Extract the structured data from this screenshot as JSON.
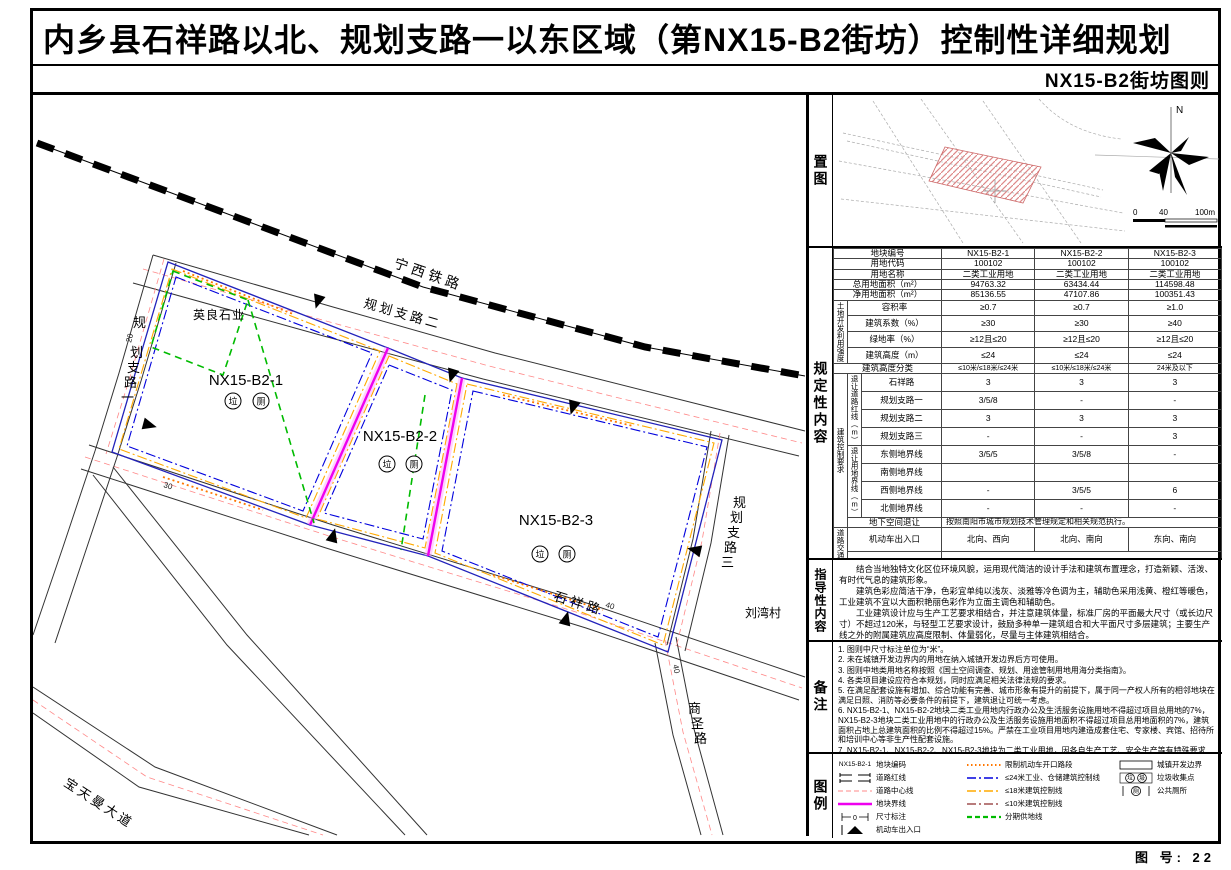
{
  "header": {
    "title": "内乡县石祥路以北、规划支路一以东区域（第NX15-B2街坊）控制性详细规划",
    "subtitle": "NX15-B2街坊图则"
  },
  "sheet_number": "图 号: 22",
  "sections": {
    "location": "置图",
    "regulatory": "规定性内容",
    "guidance": "指导性内容",
    "notes": "备注",
    "legend": "图例"
  },
  "location_map": {
    "north_label": "N",
    "scale_ticks": [
      "0",
      "40",
      "100m"
    ]
  },
  "map": {
    "roads": {
      "railway": "宁西铁路",
      "branch2": "规划支路二",
      "branch1_chars": [
        "规",
        "划",
        "支",
        "路",
        "一"
      ],
      "shixiang": "石祥路",
      "shangsheng_chars": [
        "商",
        "圣",
        "路"
      ],
      "baotianman": "宝天曼大道",
      "branch3_chars": [
        "规",
        "划",
        "支",
        "路",
        "三"
      ]
    },
    "village": "刘湾村",
    "enterprise": "英良石业",
    "plots": [
      {
        "code": "NX15-B2-1",
        "facilities": [
          "垃",
          "厕"
        ]
      },
      {
        "code": "NX15-B2-2",
        "facilities": [
          "垃",
          "厕"
        ]
      },
      {
        "code": "NX15-B2-3",
        "facilities": [
          "垃",
          "厕"
        ]
      }
    ],
    "dims": [
      "20",
      "30",
      "40",
      "40"
    ]
  },
  "reg_table": {
    "head_rows": [
      {
        "label": "地块编号",
        "values": [
          "NX15-B2-1",
          "NX15-B2-2",
          "NX15-B2-3"
        ]
      },
      {
        "label": "用地代码",
        "values": [
          "100102",
          "100102",
          "100102"
        ]
      },
      {
        "label": "用地名称",
        "values": [
          "二类工业用地",
          "二类工业用地",
          "二类工业用地"
        ]
      },
      {
        "label": "总用地面积（m²）",
        "values": [
          "94763.32",
          "63434.44",
          "114598.48"
        ]
      },
      {
        "label": "净用地面积（m²）",
        "values": [
          "85136.55",
          "47107.86",
          "100351.43"
        ]
      }
    ],
    "intensity_group": "土地开发利用强度",
    "intensity_rows": [
      {
        "label": "容积率",
        "values": [
          "≥0.7",
          "≥0.7",
          "≥1.0"
        ]
      },
      {
        "label": "建筑系数（%）",
        "values": [
          "≥30",
          "≥30",
          "≥40"
        ]
      },
      {
        "label": "绿地率（%）",
        "values": [
          "≥12且≤20",
          "≥12且≤20",
          "≥12且≤20"
        ]
      },
      {
        "label": "建筑高度（m）",
        "values": [
          "≤24",
          "≤24",
          "≤24"
        ]
      }
    ],
    "height_class": {
      "label": "建筑高度分类",
      "values": [
        "≤10米/≤18米/≤24米",
        "≤10米/≤18米/≤24米",
        "24米及以下"
      ]
    },
    "control_group": "建筑控制要求",
    "road_setback_group": "退让道路红线（m）",
    "road_setback_rows": [
      {
        "label": "石祥路",
        "values": [
          "3",
          "3",
          "3"
        ]
      },
      {
        "label": "规划支路一",
        "values": [
          "3/5/8",
          "-",
          "-"
        ]
      },
      {
        "label": "规划支路二",
        "values": [
          "3",
          "3",
          "3"
        ]
      },
      {
        "label": "规划支路三",
        "values": [
          "-",
          "-",
          "3"
        ]
      }
    ],
    "boundary_setback_group": "退让用地界线（m）",
    "boundary_setback_rows": [
      {
        "label": "东侧地界线",
        "values": [
          "3/5/5",
          "3/5/8",
          "-"
        ]
      },
      {
        "label": "南侧地界线",
        "values": [
          "",
          "",
          ""
        ]
      },
      {
        "label": "西侧地界线",
        "values": [
          "-",
          "3/5/5",
          "6"
        ]
      },
      {
        "label": "北侧地界线",
        "values": [
          "-",
          "-",
          "-"
        ]
      }
    ],
    "underground": {
      "label": "地下空间退让",
      "value": "按照南阳市城市规划技术管理规定和相关规范执行。"
    },
    "traffic_group": "道路交通设施",
    "traffic_entrance": {
      "label": "机动车出入口",
      "values": [
        "北向、西向",
        "北向、南向",
        "东向、南向"
      ]
    },
    "parking": {
      "label": "停车位配建",
      "value": "按照南阳市城市规划技术管理规定和相关规范执行。"
    },
    "support": {
      "label": "配套设施",
      "value": "按照南阳市城市规划技术管理规定和其他相关法律法规执行。"
    }
  },
  "guidance": {
    "paragraphs": [
      "结合当地独特文化区位环境风貌，运用现代简洁的设计手法和建筑布置理念，打造新颖、活泼、有时代气息的建筑形象。",
      "建筑色彩应简洁干净，色彩宜单纯以浅灰、淡雅等冷色调为主，辅助色采用浅黄、橙红等暖色，工业建筑不宜以大面积艳丽色彩作为立面主调色和辅助色。",
      "工业建筑设计应与生产工艺要求相结合，并注意建筑体量，标准厂房的平面最大尺寸（或长边尺寸）不超过120米，与轻型工艺要求设计，鼓励多种单一建筑组合和大平面尺寸多层建筑；主要生产线之外的附属建筑应高度限制、体量弱化，尽量与主体建筑相结合。"
    ]
  },
  "notes": {
    "items": [
      "1. 图则中尺寸标注单位为“米”。",
      "2. 未在城镇开发边界内的用地在纳入城镇开发边界后方可使用。",
      "3. 图则中地类用地名称按照《国土空间调查、规划、用途管制用地用海分类指南》。",
      "4. 各类项目建设应符合本规划，同时应满足相关法律法规的要求。",
      "5. 在满足配套设施有增加、综合功能有完善、城市形象有提升的前提下，属于同一产权人所有的相邻地块在满足日照、消防等必要条件的前提下，建筑退让可统一考虑。",
      "6. NX15-B2-1、NX15-B2-2地块二类工业用地内行政办公及生活服务设施用地不得超过项目总用地的7%，NX15-B2-3地块二类工业用地中的行政办公及生活服务设施用地面积不得超过项目总用地面积的7%，建筑面积占地上总建筑面积的比例不得超过15%。严禁在工业项目用地内建造成套住宅、专家楼、宾馆、招待所和培训中心等非生产性配套设施。",
      "7. NX15-B2-1、NX15-B2-2、NX15-B2-3地块为二类工业用地，因各自生产工艺、安全生产等有特殊要求的，工业用地退让、建筑密度等控制指标需按相关规定要求执行。"
    ]
  },
  "legend": {
    "plot_code_sample": "NX15-B2-1",
    "dimension_sample": "0",
    "trash_chars": [
      "垃",
      "圾"
    ],
    "toilet_char": "厕",
    "col1": [
      {
        "label": "地块编码"
      },
      {
        "label": "道路红线"
      },
      {
        "label": "道路中心线"
      },
      {
        "label": "地块界线"
      },
      {
        "label": "尺寸标注"
      },
      {
        "label": "机动车出入口"
      }
    ],
    "col2": [
      {
        "label": "限制机动车开口路段"
      },
      {
        "label": "≤24米工业、仓储建筑控制线"
      },
      {
        "label": "≤18米建筑控制线"
      },
      {
        "label": "≤10米建筑控制线"
      },
      {
        "label": "分期供地线"
      }
    ],
    "col3": [
      {
        "label": "城镇开发边界"
      },
      {
        "label": "垃圾收集点"
      },
      {
        "label": "公共厕所"
      }
    ]
  },
  "colors": {
    "plot_boundary": "#ee00ee",
    "control_24m": "#0000dd",
    "control_18m": "#ffaa00",
    "control_10m": "#a05050",
    "phase_line": "#00bb00",
    "restrict_opening": "#ff7700",
    "centerline": "#ff8888"
  }
}
